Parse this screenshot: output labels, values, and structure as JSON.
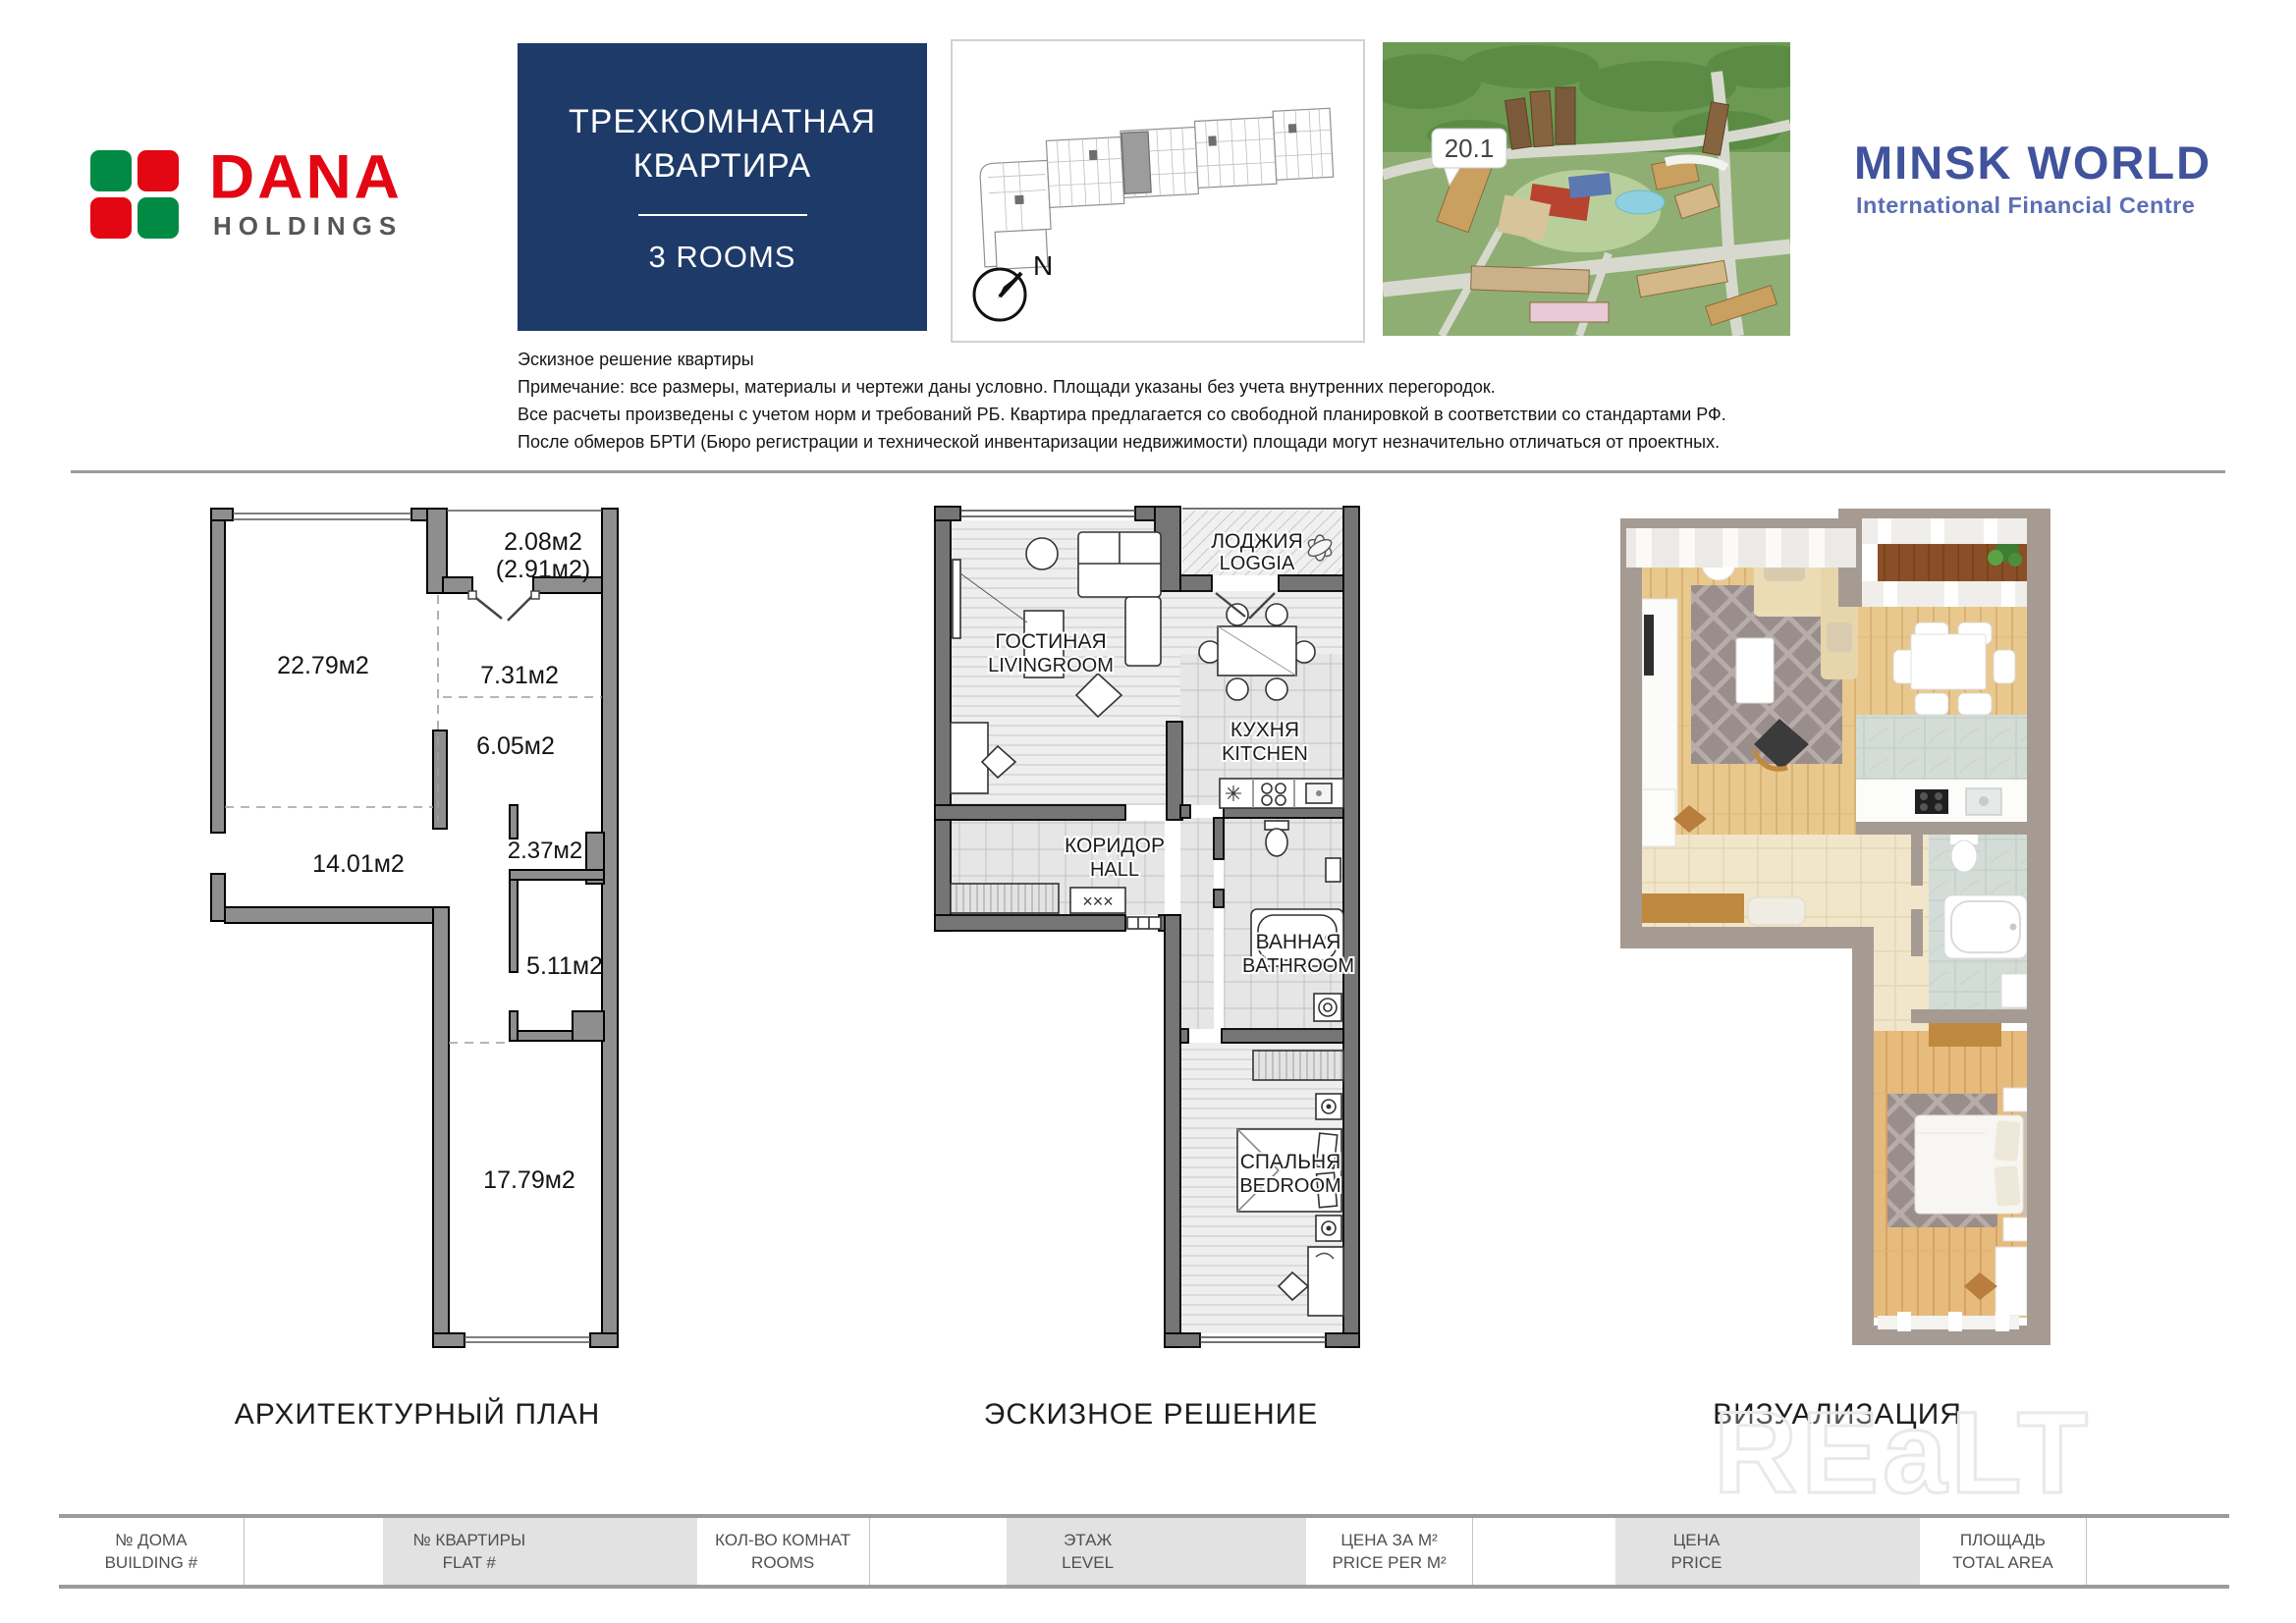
{
  "colors": {
    "navy": "#1d3a68",
    "dana_red": "#e30613",
    "dana_green": "#008a44",
    "holdings_gray": "#55565a",
    "minsk_blue": "#41539c",
    "minsk_light_blue": "#5c6fb4",
    "wall_gray": "#8e8e8e",
    "sketch_wall": "#757575",
    "viz_wall": "#a69b93"
  },
  "brand_left": {
    "name": "DANA",
    "sub": "HOLDINGS"
  },
  "brand_right": {
    "name": "MINSK WORLD",
    "sub": "International Financial Centre"
  },
  "title_box": {
    "ru_line1": "ТРЕХКОМНАТНАЯ",
    "ru_line2": "КВАРТИРА",
    "en": "3 ROOMS"
  },
  "site_plan": {
    "north": "N"
  },
  "aerial": {
    "marker": "20.1"
  },
  "notes": {
    "line1": "Эскизное решение квартиры",
    "line2": "Примечание: все размеры, материалы и чертежи даны условно. Площади указаны без учета внутренних перегородок.",
    "line3": "Все расчеты произведены с учетом норм и требований РБ. Квартира предлагается со свободной планировкой в соответствии со стандартами РФ.",
    "line4": "После обмеров БРТИ (Бюро регистрации и технической инвентаризации недвижимости) площади могут незначительно отличаться от проектных."
  },
  "plans": {
    "architectural": {
      "caption": "АРХИТЕКТУРНЫЙ ПЛАН",
      "areas": {
        "balcony": "2.08м2",
        "balcony_total": "(2.91м2)",
        "living": "22.79м2",
        "room1": "7.31м2",
        "room2": "6.05м2",
        "niche": "2.37м2",
        "hall": "14.01м2",
        "storage": "5.11м2",
        "bedroom": "17.79м2"
      }
    },
    "sketch": {
      "caption": "ЭСКИЗНОЕ РЕШЕНИЕ",
      "rooms": {
        "loggia_ru": "ЛОДЖИЯ",
        "loggia_en": "LOGGIA",
        "living_ru": "ГОСТИНАЯ",
        "living_en": "LIVINGROOM",
        "kitchen_ru": "КУХНЯ",
        "kitchen_en": "KITCHEN",
        "hall_ru": "КОРИДОР",
        "hall_en": "HALL",
        "bathroom_ru": "ВАННАЯ",
        "bathroom_en": "BATHROOM",
        "bedroom_ru": "СПАЛЬНЯ",
        "bedroom_en": "BEDROOM"
      }
    },
    "visualization": {
      "caption": "ВИЗУАЛИЗАЦИЯ"
    }
  },
  "watermark": "REaLT",
  "footer": {
    "fields": [
      {
        "ru": "№ ДОМА",
        "en": "BUILDING #"
      },
      {
        "ru": "№ КВАРТИРЫ",
        "en": "FLAT #"
      },
      {
        "ru": "КОЛ-ВО КОМНАТ",
        "en": "ROOMS"
      },
      {
        "ru": "ЭТАЖ",
        "en": "LEVEL"
      },
      {
        "ru": "ЦЕНА ЗА М²",
        "en": "PRICE PER M²"
      },
      {
        "ru": "ЦЕНА",
        "en": "PRICE"
      },
      {
        "ru": "ПЛОЩАДЬ",
        "en": "TOTAL AREA"
      }
    ]
  }
}
